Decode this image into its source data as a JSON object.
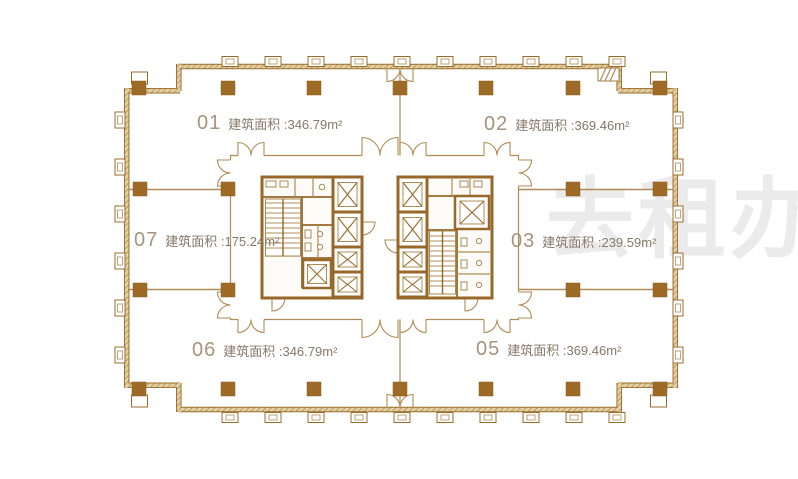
{
  "units": {
    "u01": {
      "number": "01",
      "area": "建筑面积 :346.79m²"
    },
    "u02": {
      "number": "02",
      "area": "建筑面积 :369.46m²"
    },
    "u03": {
      "number": "03",
      "area": "建筑面积 :239.59m²"
    },
    "u05": {
      "number": "05",
      "area": "建筑面积 :369.46m²"
    },
    "u06": {
      "number": "06",
      "area": "建筑面积 :346.79m²"
    },
    "u07": {
      "number": "07",
      "area": "建筑面积 :175.24m²"
    }
  },
  "watermark": {
    "text": "去租办",
    "color": "#EBEBEB"
  },
  "colors": {
    "background": "#FFFFFF",
    "wall": "#9A6C29",
    "wall_fill": "#E2CFA4",
    "column": "#9E6B26",
    "thin_line": "#AE8C55",
    "unit_number": "#A5947A",
    "unit_area": "#857869"
  }
}
